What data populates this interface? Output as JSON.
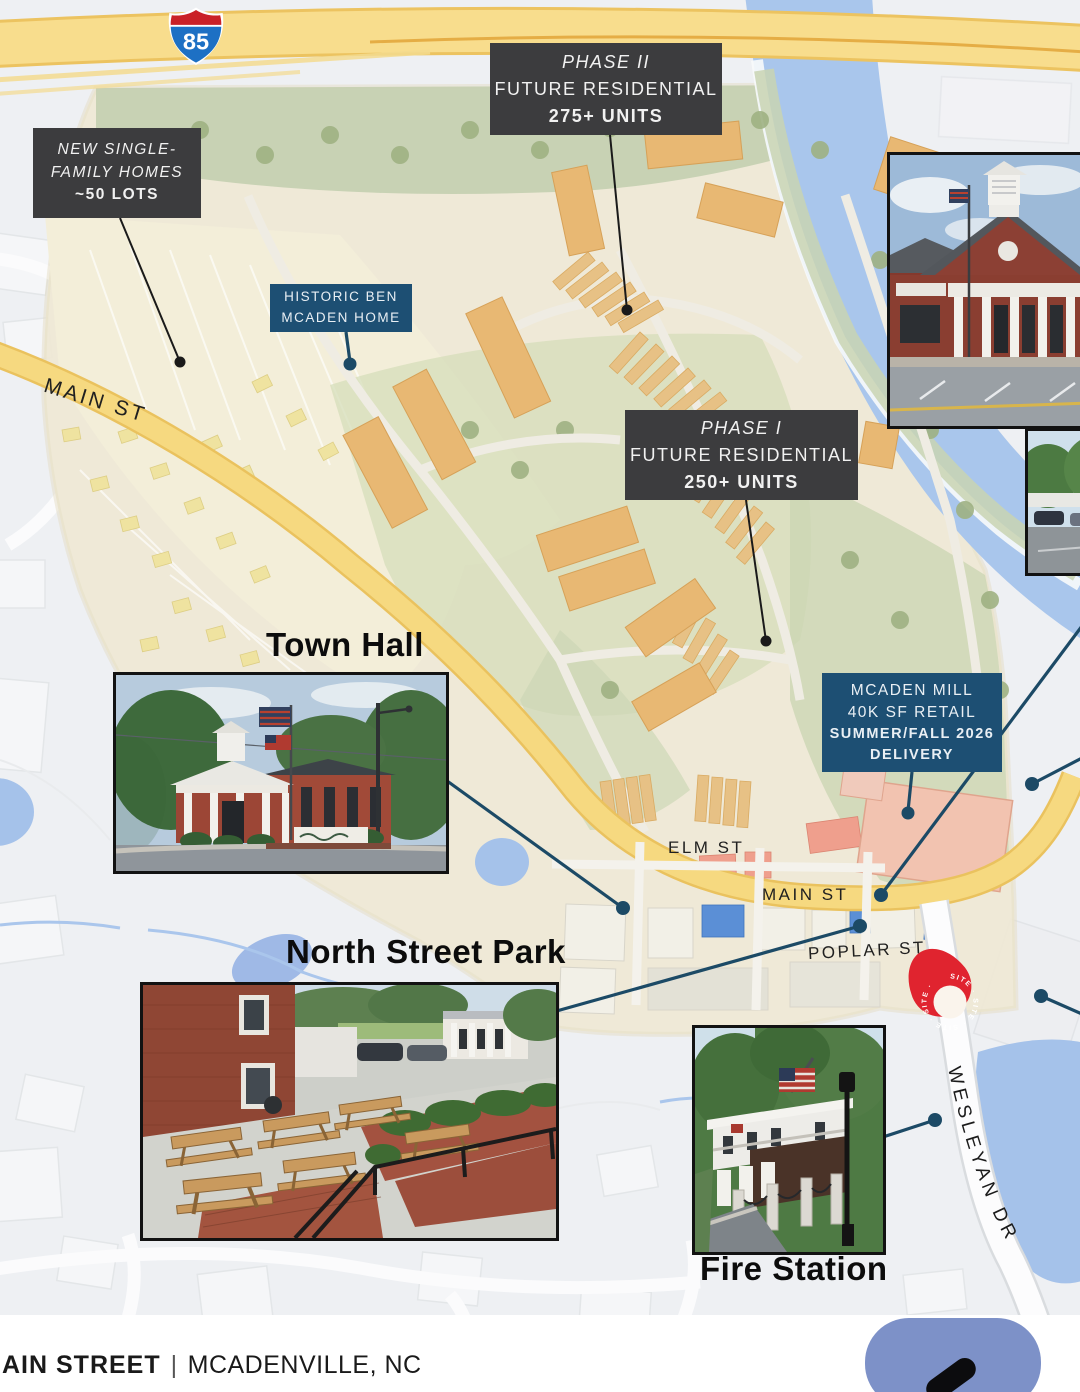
{
  "map": {
    "shield_number": "85",
    "streets": {
      "main_upper": "MAIN ST",
      "elm": "ELM ST",
      "main_lower": "MAIN ST",
      "poplar": "POPLAR ST",
      "wesleyan": "WESLEYAN DR"
    },
    "pin_ring_text": "SITE · SITE · SITE · SITE ·"
  },
  "callouts": {
    "new_homes": {
      "line1": "NEW SINGLE-",
      "line2": "FAMILY HOMES",
      "line3": "~50 LOTS"
    },
    "phase2": {
      "title": "PHASE II",
      "line2": "FUTURE RESIDENTIAL",
      "line3": "275+ UNITS"
    },
    "phase1": {
      "title": "PHASE I",
      "line2": "FUTURE RESIDENTIAL",
      "line3": "250+ UNITS"
    },
    "historic": {
      "line1": "HISTORIC BEN",
      "line2": "MCADEN HOME"
    },
    "mill": {
      "line1": "MCADEN MILL",
      "line2": "40K SF RETAIL",
      "line3": "SUMMER/FALL 2026",
      "line4": "DELIVERY"
    }
  },
  "photo_titles": {
    "town_hall": "Town Hall",
    "park": "North Street Park",
    "fire": "Fire Station"
  },
  "footer": {
    "street": "AIN STREET",
    "sep": "|",
    "city": "MCADENVILLE, NC"
  },
  "colors": {
    "callout_dark": "#3c3c3e",
    "callout_blue": "#1d4f73",
    "leader_navy": "#1c4a66",
    "leader_black": "#1a1a1a",
    "highway_yellow": "#f7dc8a",
    "road_yellow": "#f6d980",
    "river_blue": "#a9c6ec",
    "pin_red": "#e0242f",
    "app_button_blue": "#7d91c8",
    "plan_parchment": "#efe9d6",
    "plan_green": "#c6d0b2",
    "building_orange": "#e8b873",
    "mill_pink": "#f2c3b0"
  }
}
